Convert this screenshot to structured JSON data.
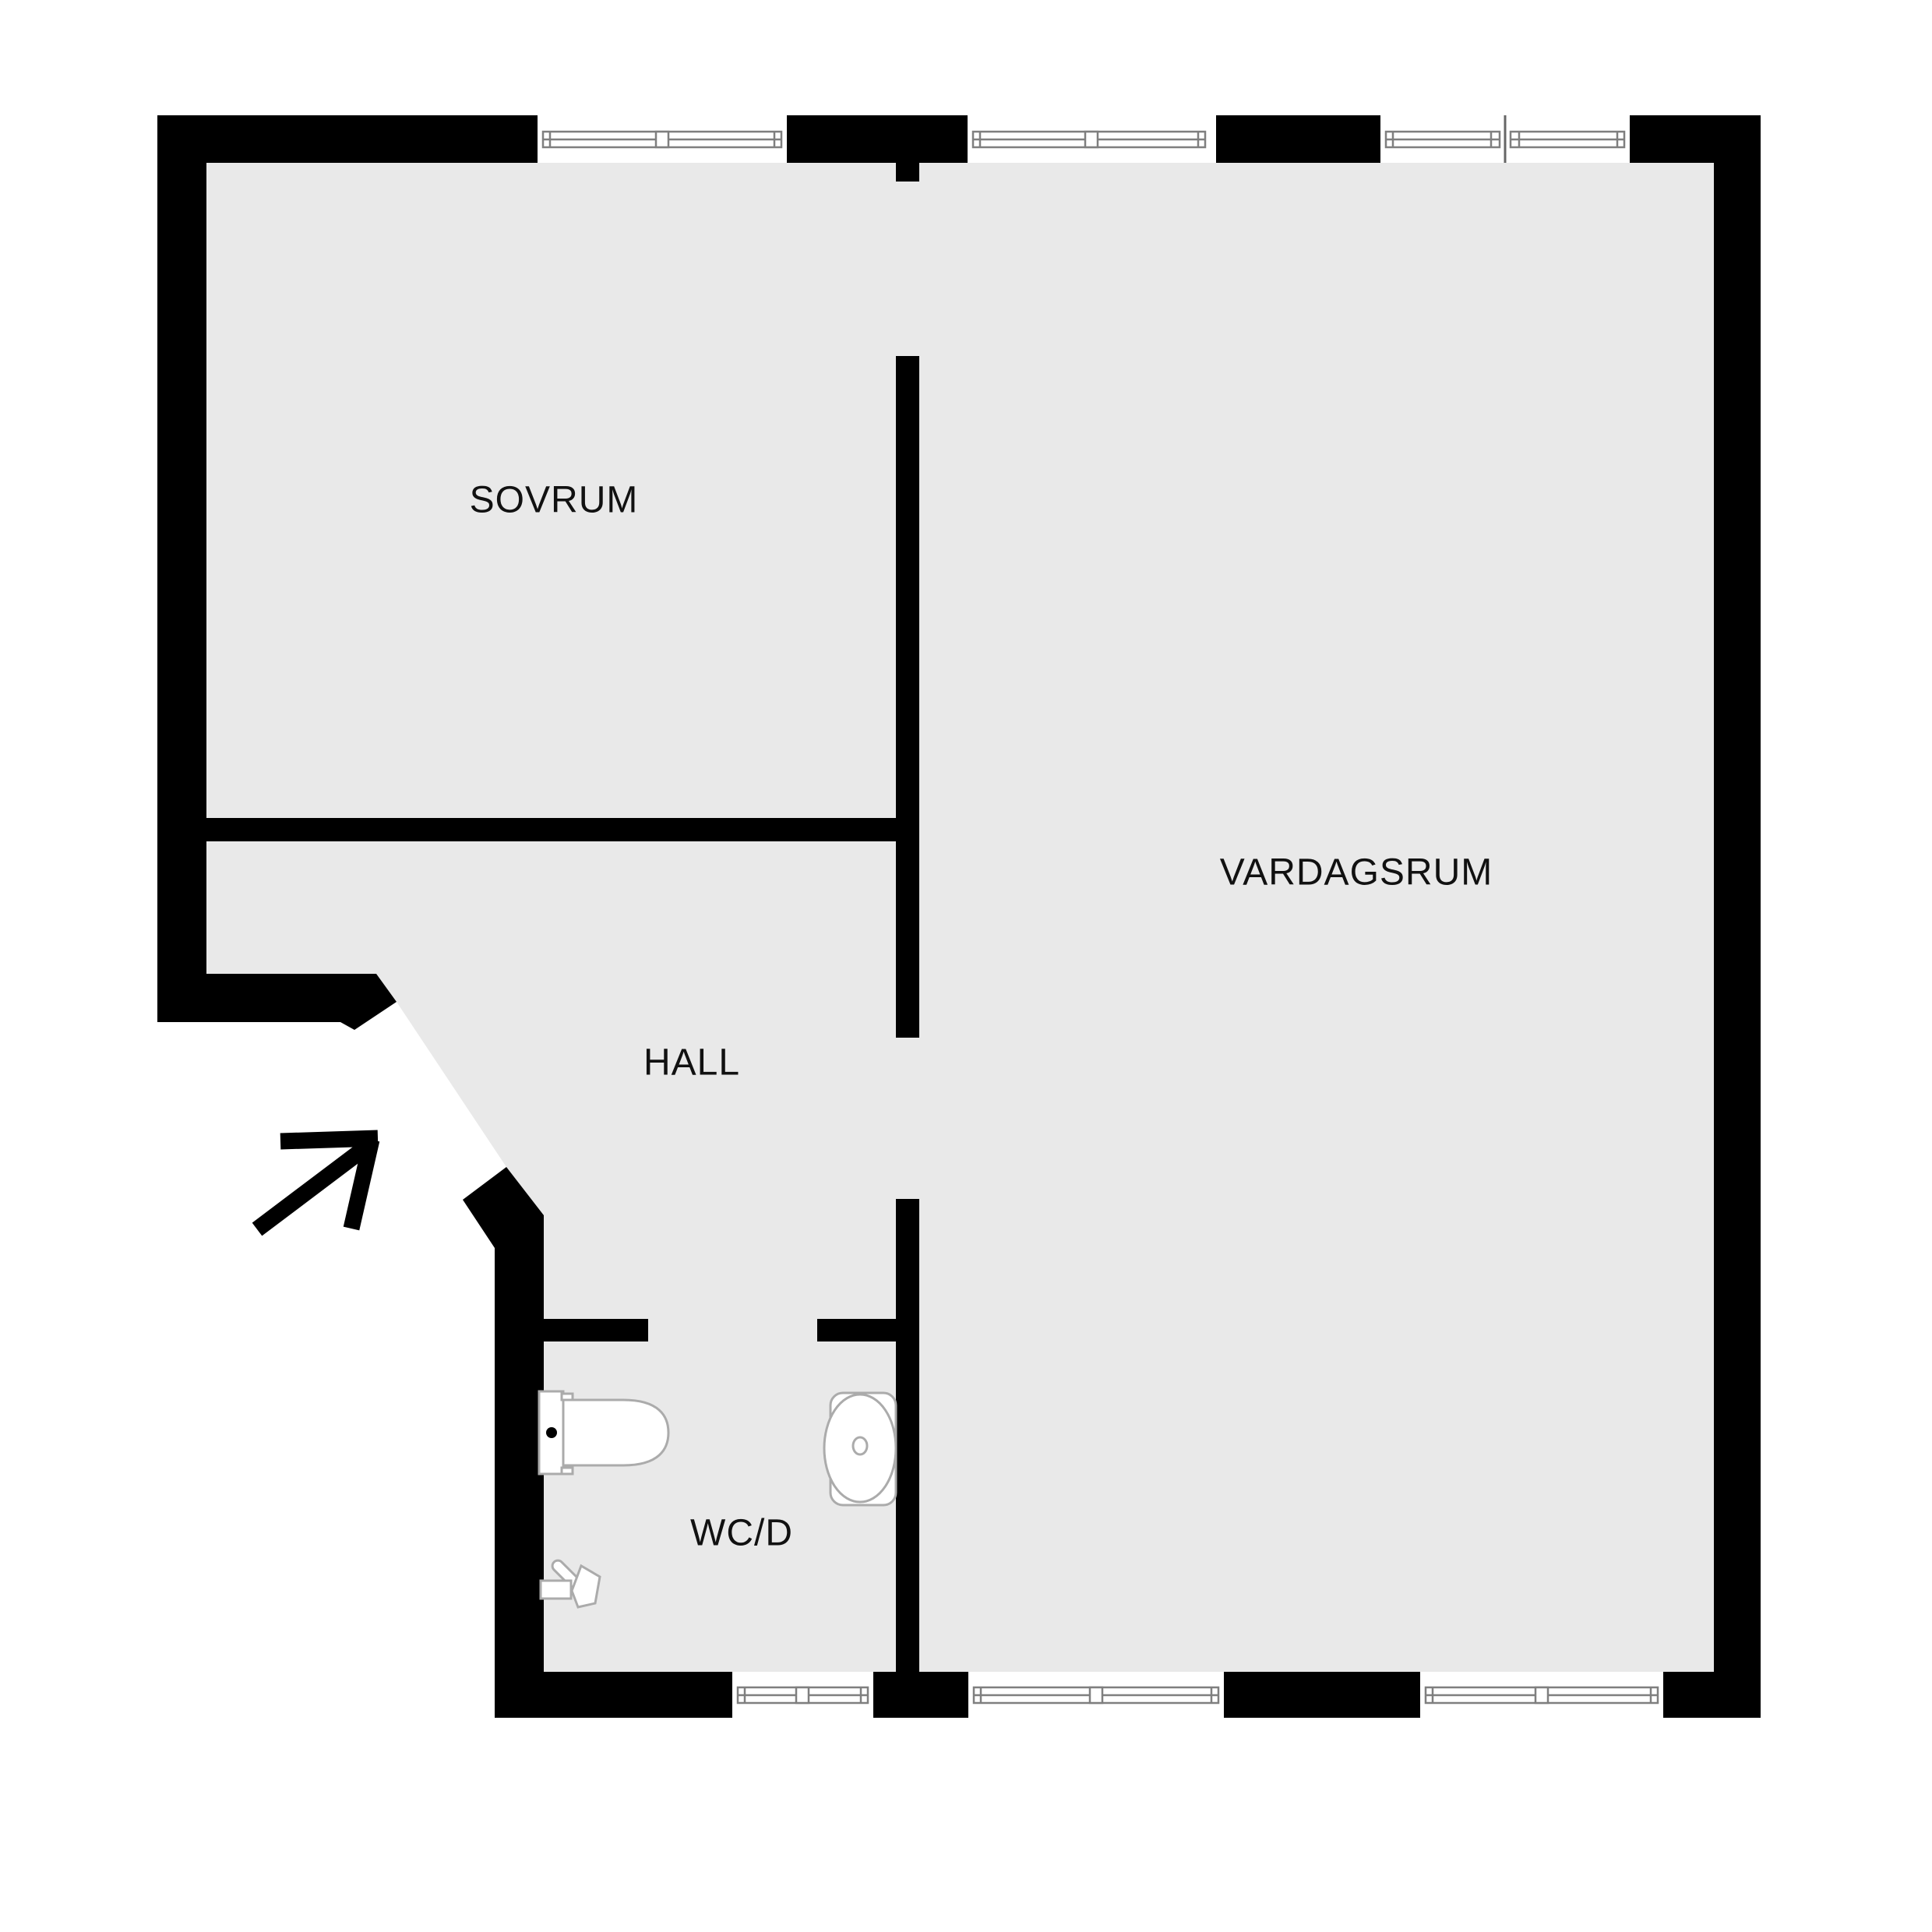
{
  "colors": {
    "wall": "#000000",
    "floor": "#e9e9e9",
    "frame": "#7f7f7f",
    "fixture": "#ababab",
    "label": "#111111",
    "background": "#ffffff"
  },
  "rooms": [
    {
      "id": "sovrum",
      "label": "SOVRUM"
    },
    {
      "id": "vardagsrum",
      "label": "VARDAGSRUM"
    },
    {
      "id": "hall",
      "label": "HALL"
    },
    {
      "id": "wcd",
      "label": "WC/D"
    }
  ],
  "icons": {
    "entrance": "entrance-direction-arrow",
    "fixtures": [
      "toilet",
      "sink-basin",
      "hand-shower"
    ],
    "window_symbols": 6
  }
}
